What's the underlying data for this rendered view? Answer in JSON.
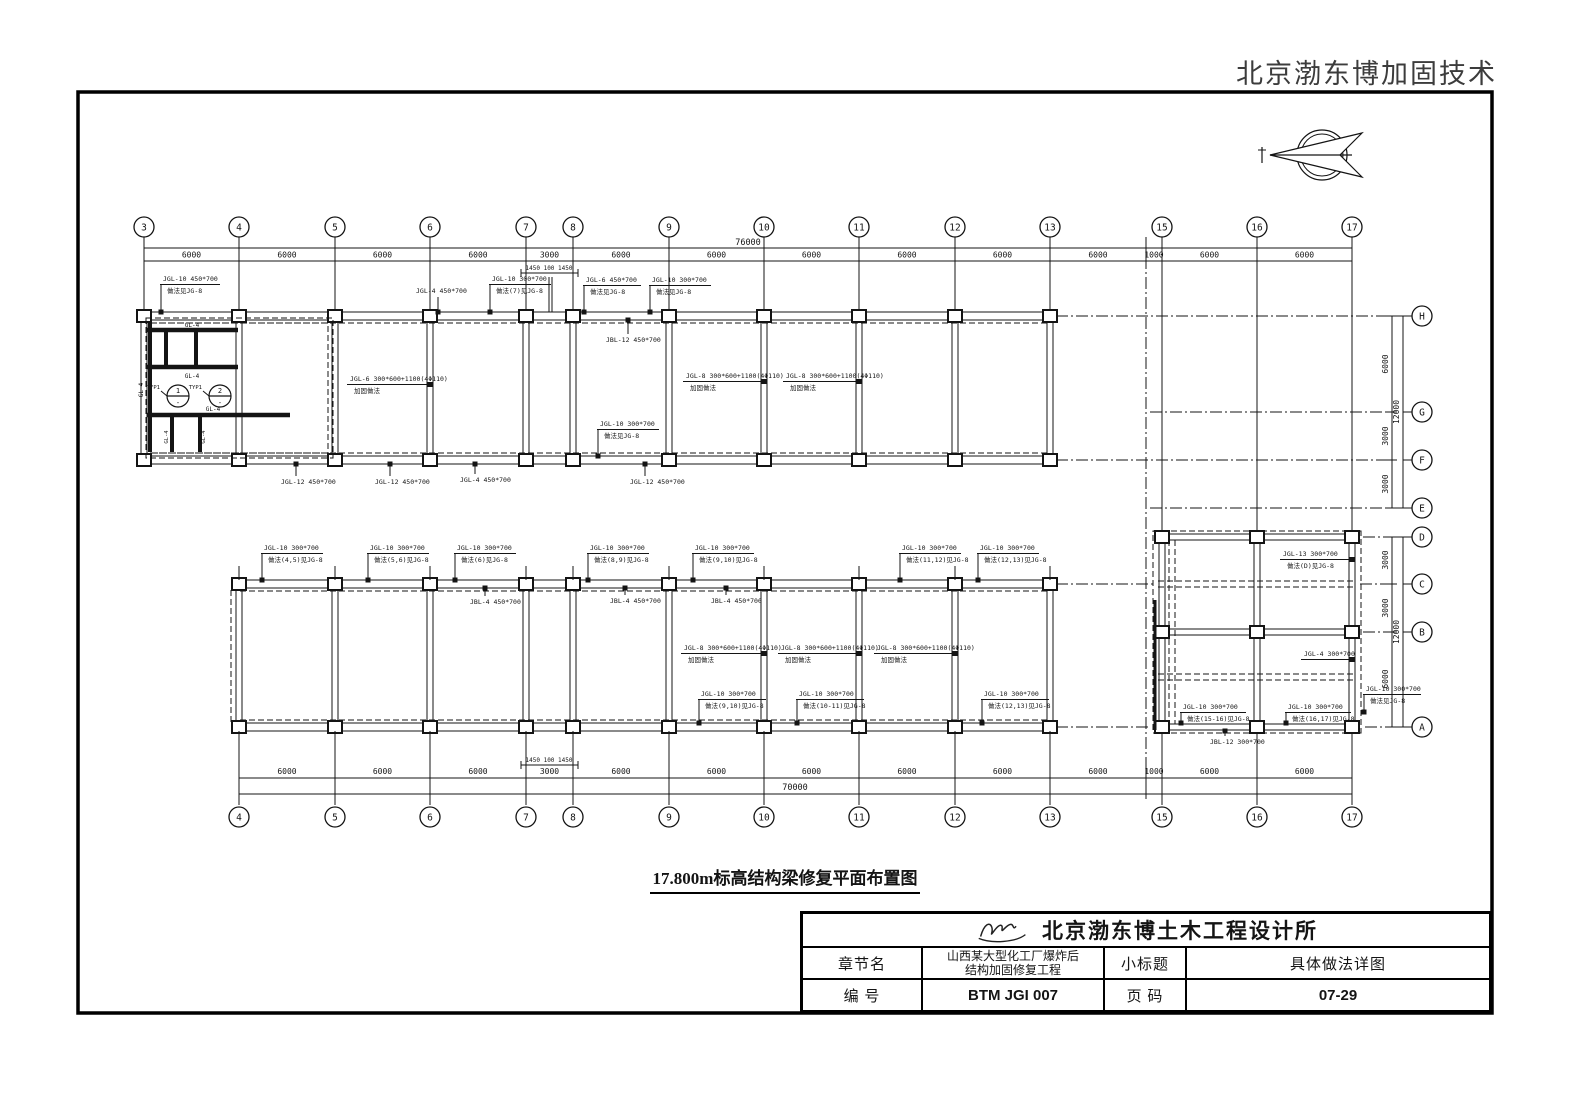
{
  "watermark": "北京渤东博加固技术",
  "sheet": {
    "drawing_title": "17.800m标高结构梁修复平面布置图"
  },
  "title_block": {
    "company": "北京渤东博土木工程设计所",
    "chapter_label": "章节名",
    "chapter_value_line1": "山西某大型化工厂爆炸后",
    "chapter_value_line2": "结构加固修复工程",
    "subtitle_label": "小标题",
    "subtitle_value": "具体做法详图",
    "number_label": "编  号",
    "number_value": "BTM JGI 007",
    "page_label": "页  码",
    "page_value": "07-29"
  },
  "grids": {
    "top": {
      "labels": [
        "3",
        "4",
        "5",
        "6",
        "7",
        "8",
        "9",
        "10",
        "11",
        "12",
        "13",
        "15",
        "16",
        "17"
      ],
      "dims": [
        "6000",
        "6000",
        "6000",
        "6000",
        "3000",
        "6000",
        "6000",
        "6000",
        "6000",
        "6000",
        "6000",
        "1000",
        "6000",
        "6000"
      ],
      "total": "76000",
      "joint": "1450 100 1450"
    },
    "bottom": {
      "labels": [
        "4",
        "5",
        "6",
        "7",
        "8",
        "9",
        "10",
        "11",
        "12",
        "13",
        "15",
        "16",
        "17"
      ],
      "dims": [
        "6000",
        "6000",
        "6000",
        "3000",
        "6000",
        "6000",
        "6000",
        "6000",
        "6000",
        "6000",
        "1000",
        "6000",
        "6000"
      ],
      "total": "70000",
      "joint": "1450 100 1450"
    },
    "right_upper": {
      "labels": [
        "H",
        "G",
        "F",
        "E"
      ],
      "dims": [
        "6000",
        "3000",
        "3000"
      ],
      "total": "12000"
    },
    "right_lower": {
      "labels": [
        "D",
        "C",
        "B",
        "A"
      ],
      "dims": [
        "3000",
        "3000",
        "6000"
      ],
      "total": "12000"
    }
  },
  "beam_labels_upper": [
    {
      "text": "JGL-10 450*700",
      "sub": "做法见JG-8"
    },
    {
      "text": "JGL-4 450*700",
      "sub": ""
    },
    {
      "text": "JGL-10 300*700",
      "sub": "做法(7)见JG-8"
    },
    {
      "text": "JGL-6 450*700",
      "sub": "做法见JG-8"
    },
    {
      "text": "JGL-10 300*700",
      "sub": "做法见JG-8"
    },
    {
      "text": "JBL-12 450*700",
      "sub": ""
    },
    {
      "text": "JGL-6 300*600+1100(4Φ110)",
      "sub": "加固做法"
    },
    {
      "text": "JGL-8 300*600+1100(4Φ110)",
      "sub": "加固做法"
    },
    {
      "text": "JGL-8 300*600+1100(4Φ110)",
      "sub": "加固做法"
    },
    {
      "text": "JGL-10 300*700",
      "sub": "做法见JG-8"
    },
    {
      "text": "JGL-12 450*700",
      "sub": ""
    },
    {
      "text": "JGL-12 450*700",
      "sub": ""
    },
    {
      "text": "JGL-4 450*700",
      "sub": ""
    },
    {
      "text": "JGL-12 450*700",
      "sub": ""
    }
  ],
  "beam_labels_lower": [
    {
      "text": "JGL-10 300*700",
      "sub": "做法(4,5)见JG-8"
    },
    {
      "text": "JGL-10 300*700",
      "sub": "做法(5,6)见JG-8"
    },
    {
      "text": "JGL-10 300*700",
      "sub": "做法(6)见JG-8"
    },
    {
      "text": "JGL-10 300*700",
      "sub": "做法(8,9)见JG-8"
    },
    {
      "text": "JGL-10 300*700",
      "sub": "做法(9,10)见JG-8"
    },
    {
      "text": "JGL-10 300*700",
      "sub": "做法(11,12)见JG-8"
    },
    {
      "text": "JGL-10 300*700",
      "sub": "做法(12,13)见JG-8"
    },
    {
      "text": "JBL-4 450*700",
      "sub": ""
    },
    {
      "text": "JBL-4 450*700",
      "sub": ""
    },
    {
      "text": "JBL-4 450*700",
      "sub": ""
    },
    {
      "text": "JGL-8 300*600+1100(4Φ110)",
      "sub": "加固做法"
    },
    {
      "text": "JGL-8 300*600+1100(4Φ110)",
      "sub": "加固做法"
    },
    {
      "text": "JGL-8 300*600+1100(4Φ110)",
      "sub": "加固做法"
    },
    {
      "text": "JGL-10 300*700",
      "sub": "做法(9,10)见JG-8"
    },
    {
      "text": "JGL-10 300*700",
      "sub": "做法(10-11)见JG-8"
    },
    {
      "text": "JGL-10 300*700",
      "sub": "做法(12,13)见JG-8"
    }
  ],
  "beam_labels_right": [
    {
      "text": "JGL-13 300*700",
      "sub": "做法(D)见JG-8"
    },
    {
      "text": "JGL-4 300*700",
      "sub": ""
    },
    {
      "text": "JGL-10 300*700",
      "sub": "做法(15-16)见JG-8"
    },
    {
      "text": "JGL-10 300*700",
      "sub": "做法(16,17)见JG-8"
    },
    {
      "text": "JGL-10 300*700",
      "sub": "做法见JG-8"
    },
    {
      "text": "JBL-12 300*700",
      "sub": ""
    }
  ],
  "detail": {
    "beam": "GL-4",
    "typ": "TYP1",
    "section_1": "1",
    "section_2": "2",
    "section_ref": "-"
  }
}
